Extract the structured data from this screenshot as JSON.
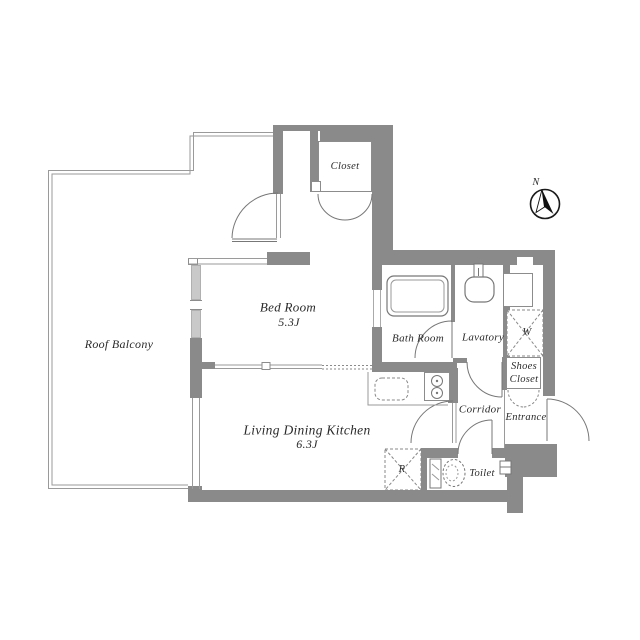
{
  "floorplan": {
    "labels": {
      "roof_balcony": "Roof Balcony",
      "bed_room": "Bed Room",
      "bed_room_area": "5.3J",
      "ldk": "Living Dining Kitchen",
      "ldk_area": "6.3J",
      "closet": "Closet",
      "bath_room": "Bath Room",
      "lavatory": "Lavatory",
      "washing_machine": "W",
      "shoes_closet_line1": "Shoes",
      "shoes_closet_line2": "Closet",
      "entrance": "Entrance",
      "corridor": "Corridor",
      "toilet": "Toilet",
      "refrigerator": "R",
      "compass_north": "N"
    },
    "colors": {
      "wall": "#8a8a8a",
      "window_glass": "#c9c9c9",
      "thin_line": "#999999",
      "fixture_line": "#777777",
      "text": "#2a2a2a",
      "background": "#ffffff"
    }
  }
}
